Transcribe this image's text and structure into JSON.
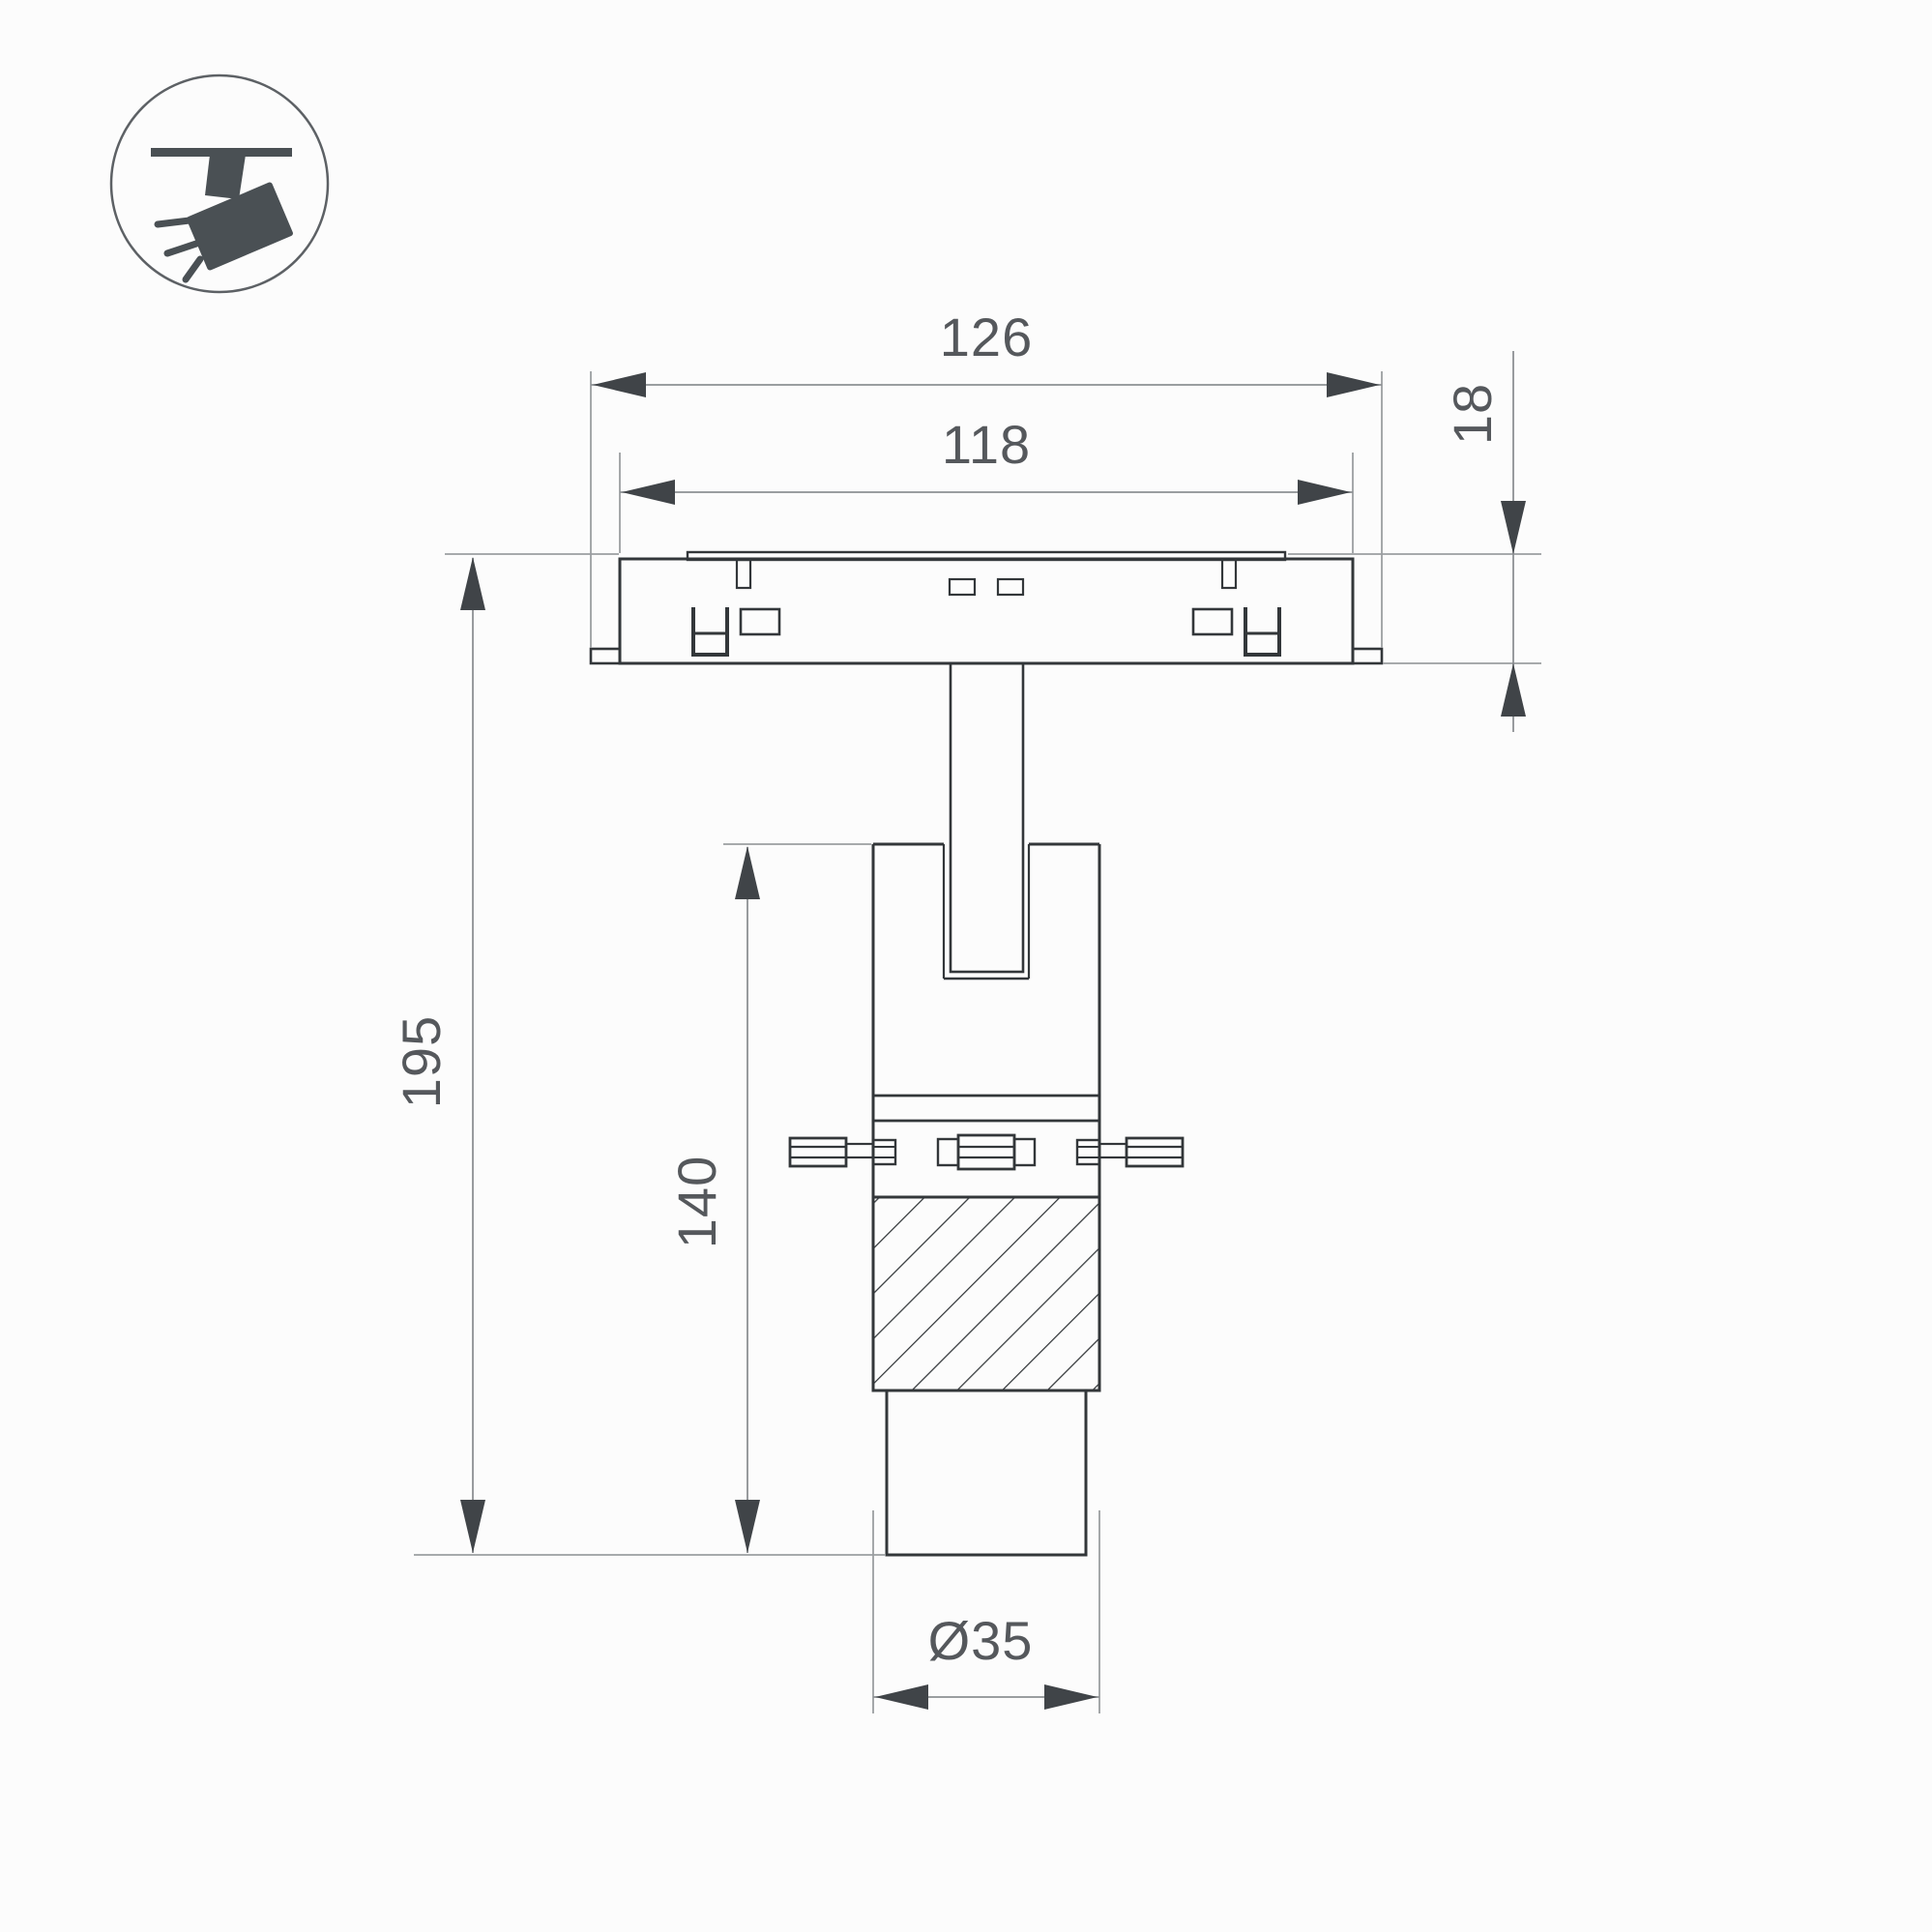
{
  "title": "Track spotlight dimension drawing",
  "icon": {
    "name": "ceiling-track-spotlight-icon"
  },
  "dimensions": {
    "plate_width": "126",
    "inner_width": "118",
    "plate_height": "18",
    "overall_height": "195",
    "body_height": "140",
    "diameter": "Ø35"
  },
  "colors": {
    "outline": "#33373a",
    "dimension_line": "#9b9ea1",
    "arrow": "#404448",
    "text": "#55585c",
    "icon": "#4a5054",
    "background": "#fcfcfc"
  }
}
